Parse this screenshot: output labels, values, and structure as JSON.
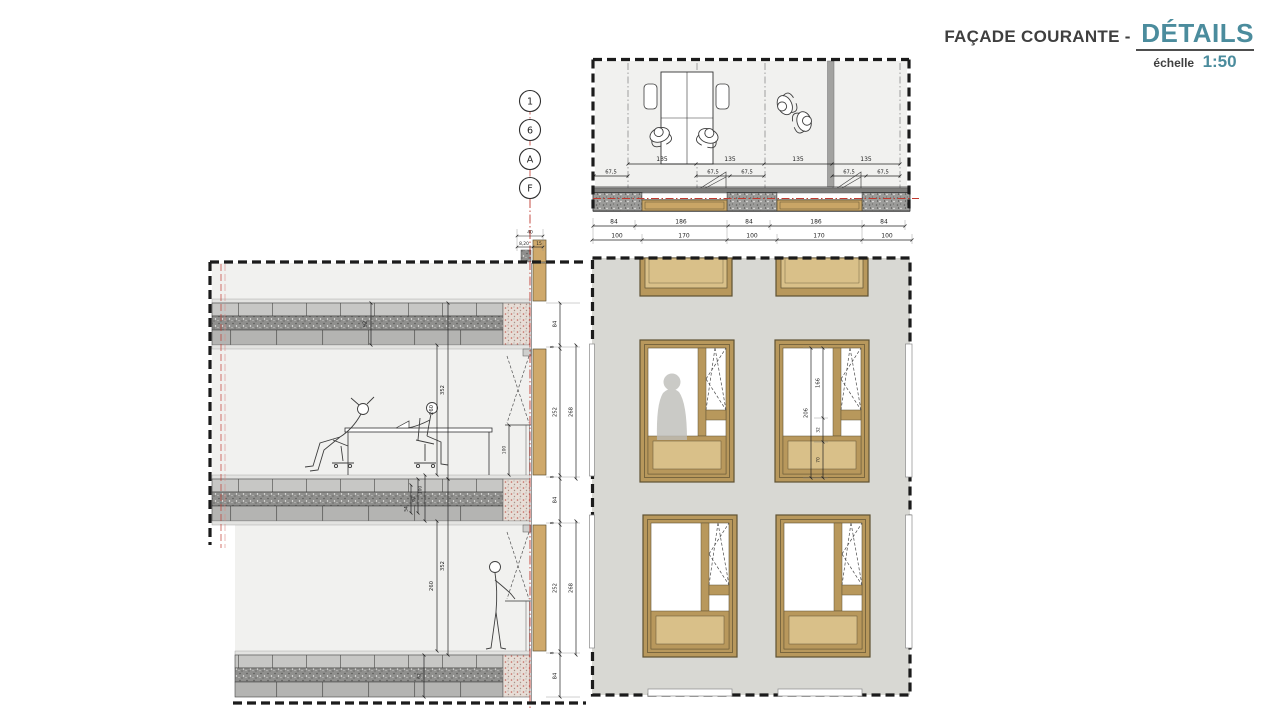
{
  "title": {
    "main": "FAÇADE COURANTE -",
    "emphasis": "DÉTAILS",
    "scale_label": "échelle",
    "scale_value": "1:50"
  },
  "colors": {
    "accent_teal": "#4b8c9d",
    "axis_red": "#c03a30",
    "frame_tan": "#b8985c",
    "panel_tan": "#d9c089",
    "facade_gray": "#d8d8d3",
    "line_dark": "#1f1f1f"
  },
  "axis_bubbles": [
    "1",
    "6",
    "A",
    "F"
  ],
  "plan": {
    "dims_module": [
      "135",
      "135",
      "135",
      "135"
    ],
    "dims_half": [
      "67,5",
      "67,5",
      "67,5",
      "67,5",
      "67,5"
    ],
    "dims_opening": [
      "84",
      "186",
      "84",
      "186",
      "84"
    ],
    "dims_frame": [
      "100",
      "170",
      "100",
      "170",
      "100"
    ]
  },
  "section": {
    "dims_top": [
      "40",
      "8,20",
      "15"
    ],
    "dim_slab_top": "92",
    "dims_mid_slab": [
      "100",
      "62",
      "54"
    ],
    "dim_slab_bottom": "62",
    "dims_floor_upper": {
      "floor_to_floor": "352",
      "clear": "260",
      "sill": "100"
    },
    "dims_floor_lower": {
      "floor_to_floor": "352",
      "clear": "260"
    }
  },
  "heights": {
    "chain": [
      "84",
      "8",
      "252",
      "8",
      "84",
      "8",
      "252",
      "8",
      "84"
    ],
    "spans": [
      "268",
      "268"
    ]
  },
  "facade": {
    "dims_window": {
      "total": "206",
      "casement": "166",
      "rail": "32",
      "spandrel": "70"
    }
  }
}
